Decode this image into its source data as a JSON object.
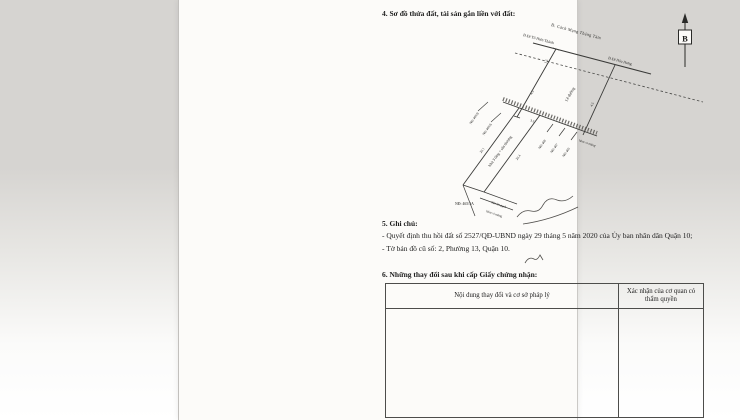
{
  "document": {
    "section4_title": "4. Sơ đồ thửa đất, tài sản gắn liền với đất:",
    "north_label": "B"
  },
  "diagram": {
    "street_main": "Đ. Cách Mạng Tháng Tám",
    "street_left": "Đ.Đi Tô Hiến Thành",
    "street_right": "Đ.Đi Hòa Hưng",
    "sidewalk_label": "Lề đường",
    "house_label": "Nhà 3 tầng + sân thượng",
    "dim_road_half": "1.5",
    "dim_sidewalk_left": "4.5",
    "dim_sidewalk_right": "4.5",
    "dim_frontage": "3.5",
    "dim_depth_left": "20.1",
    "dim_depth_right": "20.4",
    "neighbor_465_8": "NĐ 465/8",
    "neighbor_465_6": "NĐ 465/6",
    "neighbor_469": "NĐ 469",
    "neighbor_467": "NĐ 467",
    "neighbor_465": "NĐ 465",
    "alley_front": "hẻm xi măng",
    "plot_address": "NĐ: 465/5A",
    "yard_label": "Sân lót gạch",
    "alley_back": "hẻm xi măng"
  },
  "section5": {
    "title": "5. Ghi chú:",
    "note1": "- Quyết định thu hồi đất số 2527/QĐ-UBND ngày 29 tháng 5 năm 2020 của Ủy ban nhân dân Quận 10;",
    "note2": "- Tờ bản đồ cũ số: 2, Phường 13, Quận 10."
  },
  "section6": {
    "title": "6. Những thay đổi sau khi cấp Giấy chứng nhận:",
    "table": {
      "col1_header": "Nội dung thay đổi và cơ sở pháp lý",
      "col2_header": "Xác nhận của cơ quan có thẩm quyền"
    }
  }
}
